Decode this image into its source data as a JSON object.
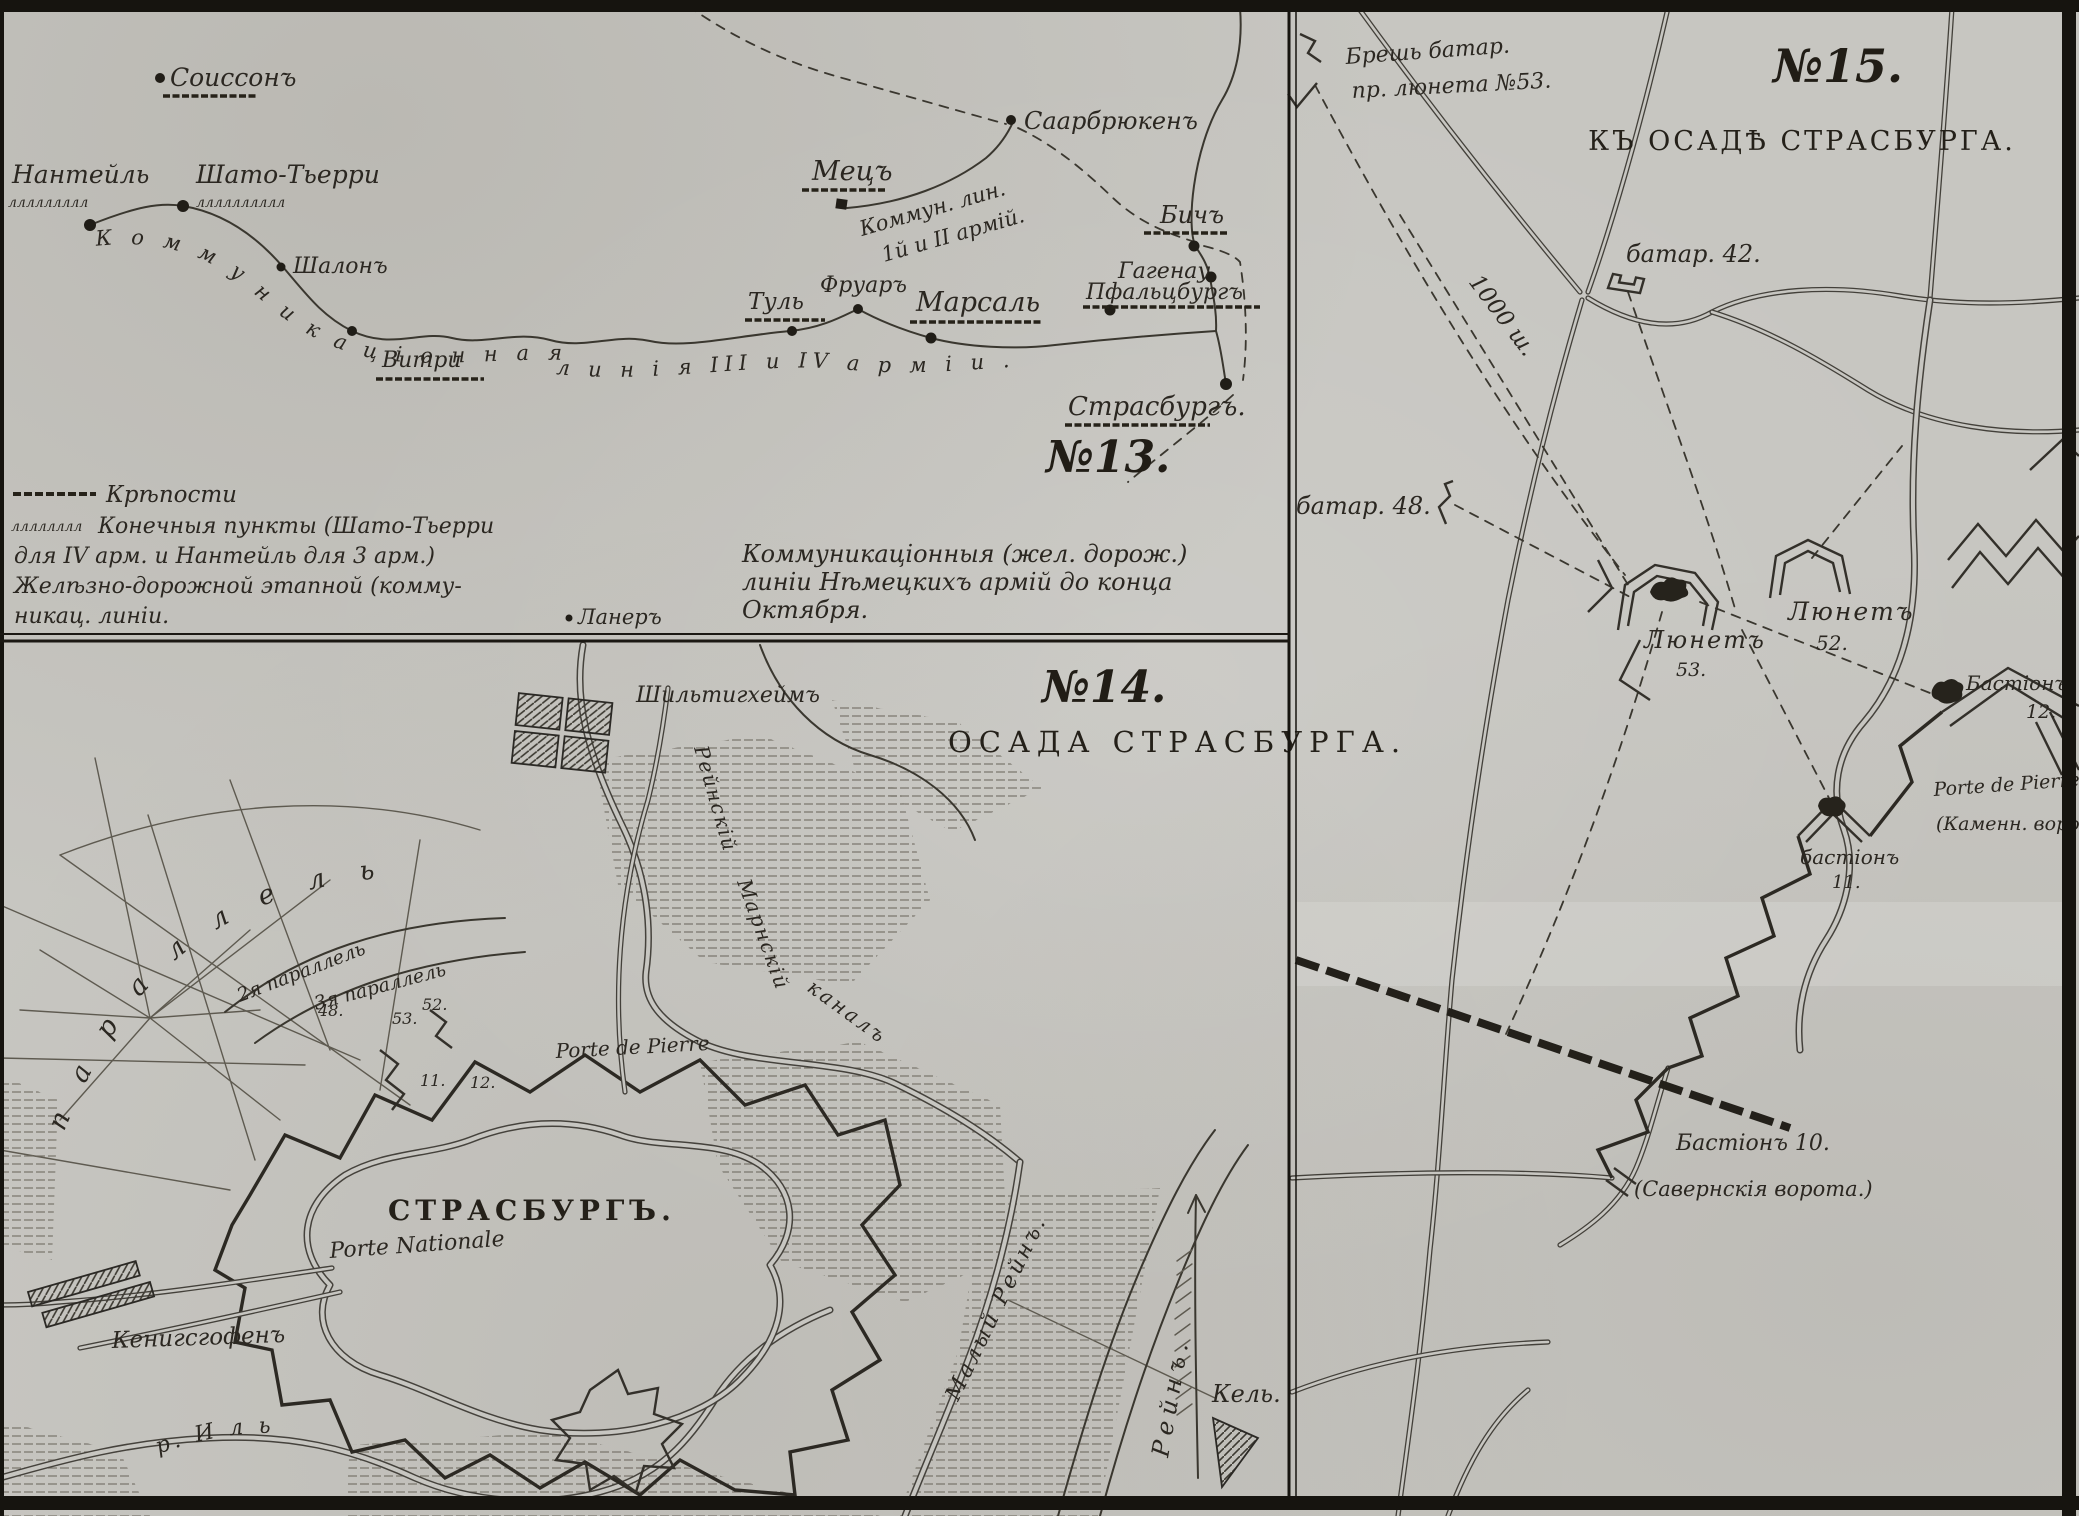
{
  "panel13": {
    "number": "№13.",
    "cities": {
      "soissons": "Соиссонъ",
      "nanteuil": "Нантейль",
      "chateau_thierry": "Шато-Тьерри",
      "chalons": "Шалонъ",
      "vitry": "Витри",
      "metz": "Мецъ",
      "saarbruecken": "Саарбрюкенъ",
      "toul": "Туль",
      "frouard": "Фруаръ",
      "marsal": "Марсаль",
      "bitche": "Бичъ",
      "hagenau": "Гагенау",
      "pfalzburg": "Пфальцбургъ",
      "strasbourg": "Страсбургъ.",
      "laner": "Ланеръ"
    },
    "line_labels": {
      "armies_1_2_line1": "Коммун. лин.",
      "armies_1_2_line2": "1й и II армій.",
      "scatter_west": "К о м м у н и к а ц і о н н а я",
      "scatter_east": "л и н і я  III и IV а р м і и ."
    },
    "caption": {
      "line1": "Коммуникаціонныя (жел. дорож.)",
      "line2": "линіи Нѣмецкихъ армій до конца",
      "line3": "Октября."
    },
    "legend": {
      "fortresses": "Крѣпости",
      "endpoints_line1": "Конечныя пункты (Шато-Тьерри",
      "endpoints_line2": "для IV арм. и Нантейль для 3 арм.)",
      "endpoints_line3": "Желѣзно-дорожной этапной (комму-",
      "endpoints_line4": "никац. линіи.",
      "squiggle": "лллллллл"
    },
    "squiggles": {
      "nanteuil": "ллллллллл",
      "chateau": "лллллллллл"
    }
  },
  "panel14": {
    "number": "№14.",
    "title": "ОСАДА СТРАСБУРГА.",
    "labels": {
      "schiltigheim": "Шильтигхеймъ",
      "city": "СТРАСБУРГЪ.",
      "porte_nationale": "Porte Nationale",
      "porte_de_pierre": "Porte de Pierre",
      "koenigshofen": "Кенигсгофенъ",
      "ill_river": "р. И л ь",
      "maly_rhein": "Малый Рейнъ.",
      "rhein": "Рейнъ.",
      "kehl": "Кель.",
      "canal_part1": "Рейнскій",
      "canal_part2": "Марнскій",
      "canal_part3": "каналъ",
      "parallel_2": "2я параллель",
      "parallel_3": "3я параллель",
      "scatter_parallel": "п а р а л л е л ь"
    },
    "fort_numbers": {
      "n48": "48.",
      "n53": "53.",
      "n52": "52.",
      "n11": "11.",
      "n12": "12."
    }
  },
  "panel15": {
    "number": "№15.",
    "title": "КЪ ОСАДѢ СТРАСБУРГА.",
    "labels": {
      "breach_line1": "Брешь батар.",
      "breach_line2": "пр. люнета №53.",
      "battery42": "батар. 42.",
      "battery48": "батар. 48.",
      "distance": "1000 ш.",
      "lunette52_name": "Люнетъ",
      "lunette52_num": "52.",
      "lunette53_name": "Люнетъ",
      "lunette53_num": "53.",
      "bastion12_name": "Бастіонъ",
      "bastion12_num": "12.",
      "bastion11_name": "бастіонъ",
      "bastion11_num": "11.",
      "porte_de_pierre": "Porte de Pierre",
      "stone_gate": "(Каменн. ворота)",
      "bastion10": "Бастіонъ 10.",
      "saverne_gate": "(Савернскія ворота.)"
    }
  },
  "colors": {
    "paper": "#c7c6c1",
    "ink": "#2b2721",
    "line": "#3a372f"
  }
}
